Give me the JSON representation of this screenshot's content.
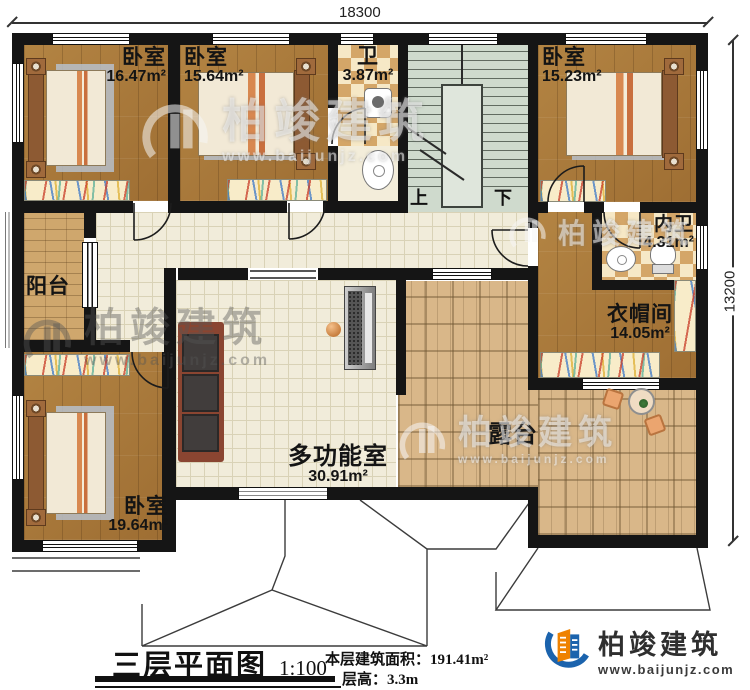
{
  "dimensions": {
    "width_mm": "18300",
    "height_mm": "13200"
  },
  "rooms": [
    {
      "name": "卧室",
      "area": "16.47m²"
    },
    {
      "name": "卧室",
      "area": "15.64m²"
    },
    {
      "name": "卫",
      "area": "3.87m²"
    },
    {
      "name": "卧室",
      "area": "15.23m²"
    },
    {
      "name": "内卫",
      "area": "4.31m²"
    },
    {
      "name": "衣帽间",
      "area": "14.05m²"
    },
    {
      "name": "阳台",
      "area": ""
    },
    {
      "name": "卧室",
      "area": "19.64m²"
    },
    {
      "name": "多功能室",
      "area": "30.91m²"
    },
    {
      "name": "露台",
      "area": ""
    }
  ],
  "stairs": {
    "up_label": "上",
    "down_label": "下"
  },
  "footer": {
    "plan_title": "三层平面图",
    "scale": "1:100",
    "area_label": "本层建筑面积：",
    "area_value": "191.41m²",
    "height_label": "层高：",
    "height_value": "3.3m"
  },
  "brand": {
    "name": "柏竣建筑",
    "url": "www.baijunjz.com"
  },
  "watermark": {
    "name": "柏竣建筑",
    "url": "www.baijunjz.com"
  }
}
